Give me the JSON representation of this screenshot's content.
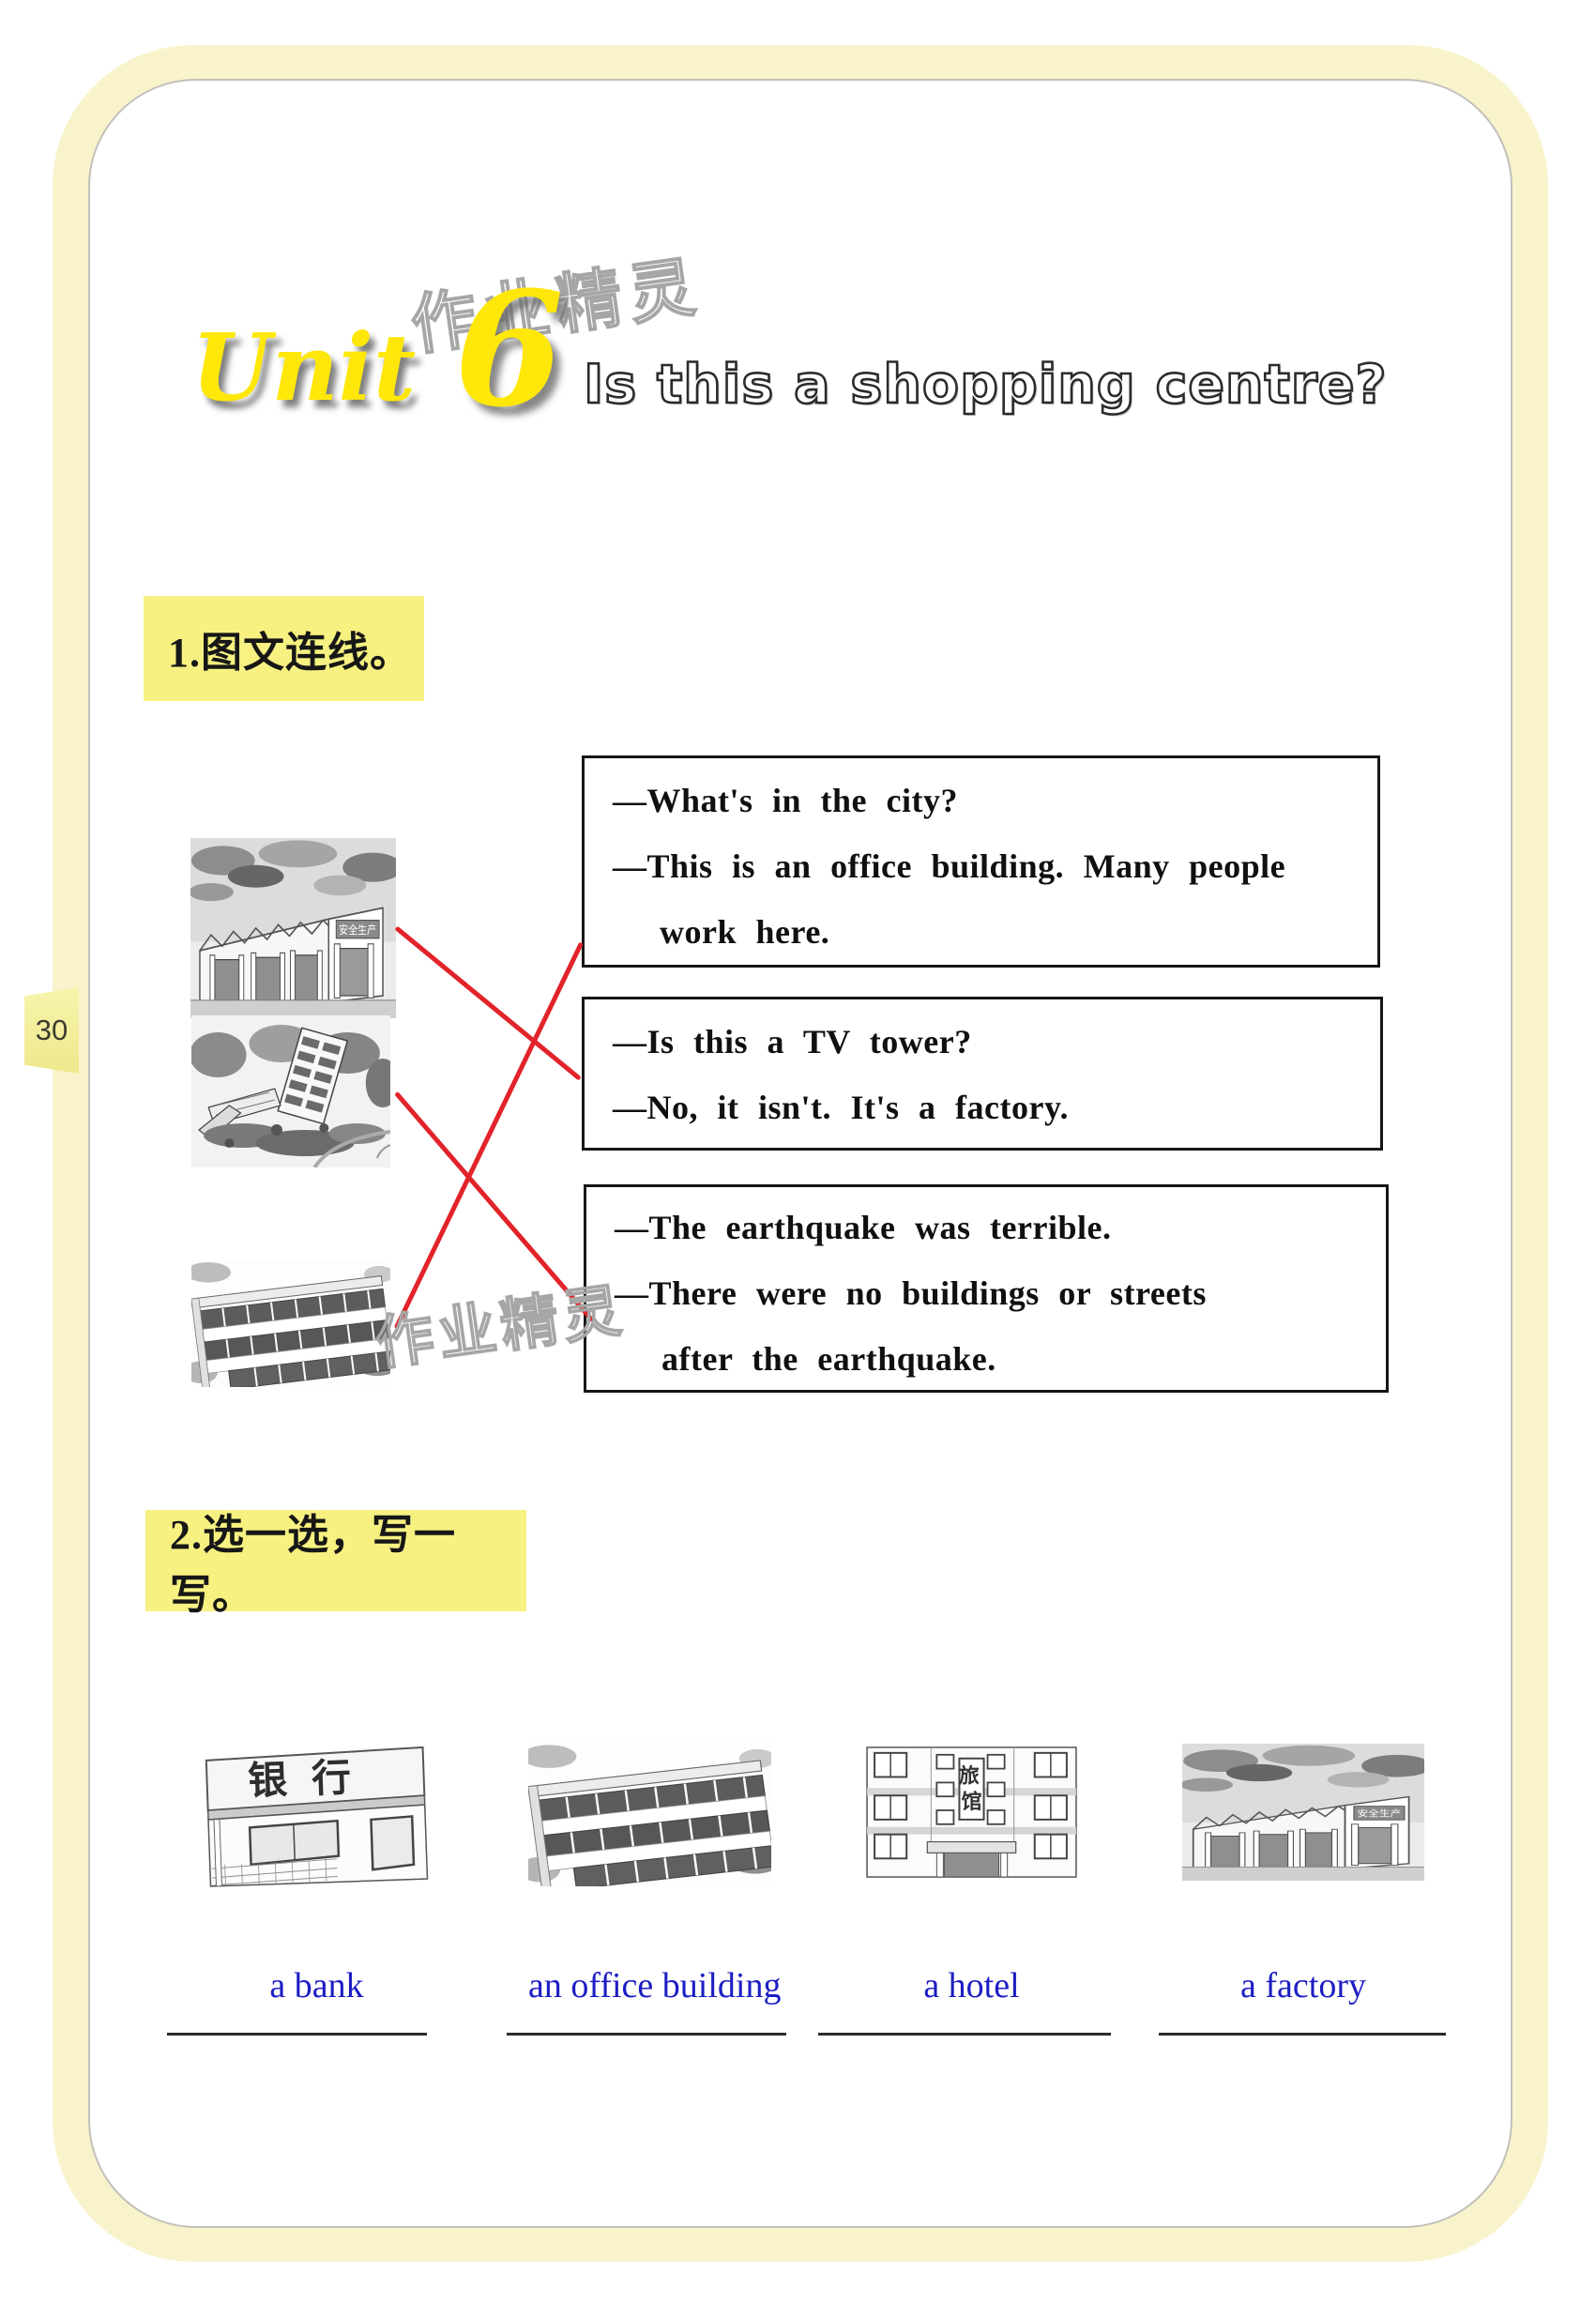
{
  "page": {
    "number": "30"
  },
  "watermark": {
    "text": "作业精灵"
  },
  "header": {
    "unit_word": "Unit",
    "unit_number": "6",
    "title": "Is this a shopping centre?"
  },
  "signs": {
    "factory": "安全生产",
    "bank": "银行",
    "hotel_top": "旅",
    "hotel_bottom": "馆"
  },
  "section1": {
    "heading": "1.图文连线。",
    "pictures": [
      "factory",
      "earthquake ruins",
      "office building"
    ],
    "boxes": [
      {
        "lines": [
          "—What's in the city?",
          "—This is an office building. Many people",
          "work here."
        ]
      },
      {
        "lines": [
          "—Is this a TV tower?",
          "—No, it isn't. It's a factory."
        ]
      },
      {
        "lines": [
          "—The earthquake was terrible.",
          "—There were no buildings or streets",
          "after the earthquake."
        ]
      }
    ]
  },
  "section2": {
    "heading": "2.选一选，写一写。",
    "labels": [
      "a bank",
      "an office building",
      "a hotel",
      "a factory"
    ]
  },
  "colors": {
    "highlight_yellow": "#f6f181",
    "title_yellow": "#ffe70a",
    "answer_blue": "#1d1dc4",
    "match_line_red": "#e2232a",
    "cream_border": "#f9f3cc"
  }
}
